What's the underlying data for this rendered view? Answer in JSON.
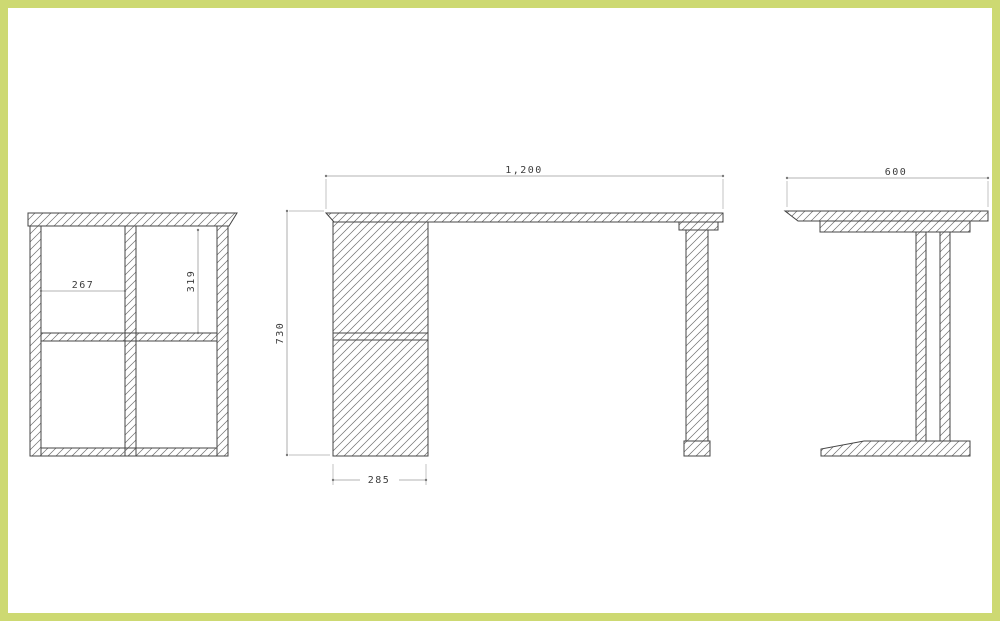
{
  "meta": {
    "type": "furniture-cad-drawing",
    "subject": "desk with pedestal cabinet",
    "views_count": 3
  },
  "colors": {
    "frame_border": "#cdd972",
    "background": "#ffffff",
    "outline": "#454545",
    "hatch": "#6e6e6e",
    "dim_line": "#9a9a9a",
    "dim_text": "#3d3d3d"
  },
  "views": {
    "cabinet_front": {
      "name": "pedestal cabinet front section",
      "dims": {
        "inner_width": "267",
        "inner_height": "319"
      }
    },
    "desk_front": {
      "name": "desk front elevation",
      "dims": {
        "overall_width": "1,200",
        "overall_height": "730",
        "pedestal_width": "285"
      }
    },
    "desk_side": {
      "name": "desk side elevation",
      "dims": {
        "overall_depth": "600"
      }
    }
  }
}
